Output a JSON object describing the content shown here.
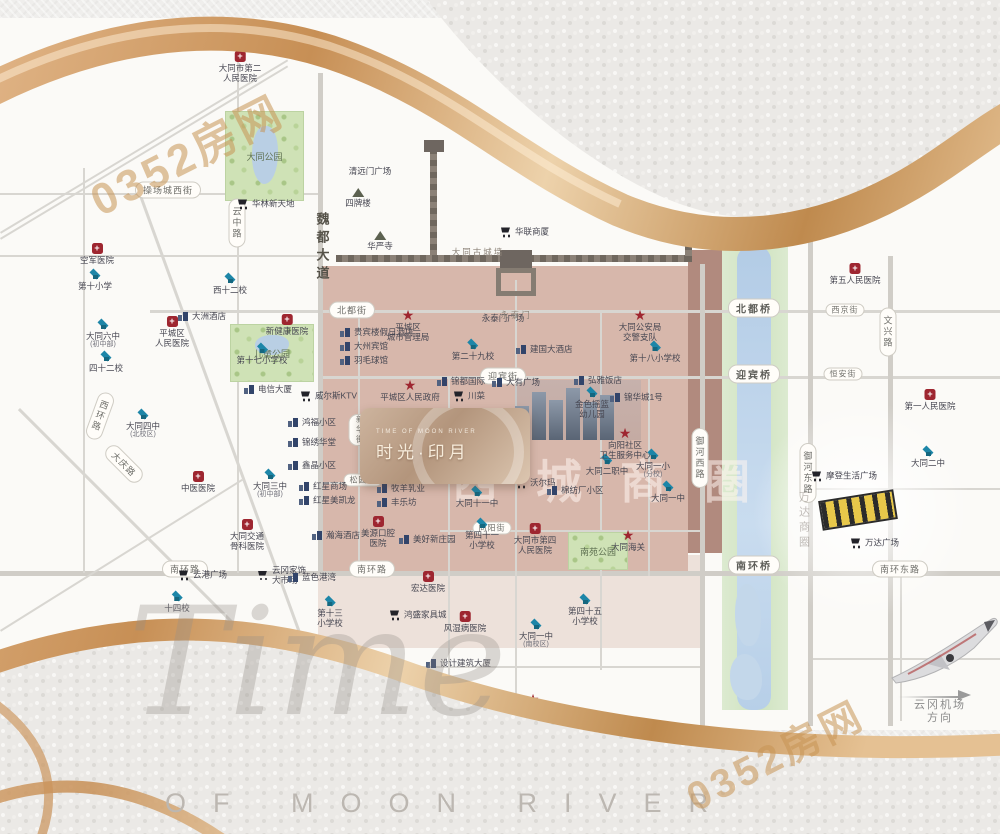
{
  "brand": {
    "script": "Time",
    "line": "OF MOON RIVER"
  },
  "watermark": {
    "text": "0352房网"
  },
  "logo": {
    "en": "TIME OF MOON RIVER",
    "cn": "时光·印月"
  },
  "ghost_label": "西城商圈",
  "map": {
    "parks": [
      {
        "x": 225,
        "y": 93,
        "w": 77,
        "h": 88,
        "label": "大同公园",
        "lake": {
          "x": 26,
          "y": 14,
          "w": 26,
          "h": 58
        }
      },
      {
        "x": 230,
        "y": 306,
        "w": 82,
        "h": 56,
        "label": "儿童公园",
        "lake": {
          "x": 24,
          "y": 10,
          "w": 34,
          "h": 20
        }
      },
      {
        "x": 568,
        "y": 514,
        "w": 58,
        "h": 36,
        "label": "南苑公园",
        "lake": null
      }
    ],
    "roads": [
      {
        "o": "h",
        "x": 0,
        "y": 175,
        "len": 320,
        "w": 2
      },
      {
        "o": "h",
        "x": 0,
        "y": 237,
        "len": 318,
        "w": 2
      },
      {
        "o": "h",
        "x": 150,
        "y": 292,
        "len": 850,
        "w": 3
      },
      {
        "o": "h",
        "x": 318,
        "y": 358,
        "len": 682,
        "w": 3
      },
      {
        "o": "h",
        "x": 318,
        "y": 464,
        "len": 197,
        "w": 2
      },
      {
        "o": "h",
        "x": 440,
        "y": 512,
        "len": 260,
        "w": 2
      },
      {
        "o": "h",
        "x": 0,
        "y": 553,
        "len": 1000,
        "w": 5
      },
      {
        "o": "h",
        "x": 318,
        "y": 648,
        "len": 382,
        "w": 2
      },
      {
        "o": "h",
        "x": 808,
        "y": 470,
        "len": 192,
        "w": 2
      },
      {
        "o": "h",
        "x": 808,
        "y": 640,
        "len": 192,
        "w": 2
      },
      {
        "o": "v",
        "x": 83,
        "y": 150,
        "len": 405,
        "w": 2
      },
      {
        "o": "v",
        "x": 237,
        "y": 30,
        "len": 525,
        "w": 2
      },
      {
        "o": "v",
        "x": 318,
        "y": 55,
        "len": 500,
        "w": 5
      },
      {
        "o": "v",
        "x": 358,
        "y": 292,
        "len": 261,
        "w": 2
      },
      {
        "o": "v",
        "x": 448,
        "y": 358,
        "len": 300,
        "w": 2
      },
      {
        "o": "v",
        "x": 515,
        "y": 262,
        "len": 440,
        "w": 2
      },
      {
        "o": "v",
        "x": 600,
        "y": 292,
        "len": 360,
        "w": 2
      },
      {
        "o": "v",
        "x": 648,
        "y": 358,
        "len": 200,
        "w": 2
      },
      {
        "o": "v",
        "x": 700,
        "y": 246,
        "len": 462,
        "w": 5
      },
      {
        "o": "v",
        "x": 808,
        "y": 222,
        "len": 486,
        "w": 5
      },
      {
        "o": "v",
        "x": 888,
        "y": 238,
        "len": 470,
        "w": 5
      },
      {
        "o": "v",
        "x": 900,
        "y": 553,
        "len": 150,
        "w": 2
      },
      {
        "o": "d",
        "x": 140,
        "y": 172,
        "len": 565,
        "w": 3,
        "ang": 70
      },
      {
        "o": "d",
        "x": 20,
        "y": 390,
        "len": 440,
        "w": 3,
        "ang": 45
      },
      {
        "o": "d",
        "x": 0,
        "y": 612,
        "len": 285,
        "w": 2,
        "ang": -32
      },
      {
        "o": "d",
        "x": 0,
        "y": 214,
        "len": 335,
        "w": 2,
        "ang": -31
      },
      {
        "o": "d",
        "x": 0,
        "y": 220,
        "len": 335,
        "w": 2,
        "ang": -31
      }
    ],
    "capsules": [
      {
        "x": 168,
        "y": 172,
        "t": "操场城西街"
      },
      {
        "x": 237,
        "y": 205,
        "t": "云中路",
        "vert": true
      },
      {
        "x": 322,
        "y": 230,
        "t": "魏都大道",
        "vert": true,
        "plain": true
      },
      {
        "x": 352,
        "y": 292,
        "t": "北都街"
      },
      {
        "x": 503,
        "y": 358,
        "t": "迎宾街"
      },
      {
        "x": 100,
        "y": 398,
        "t": "西环路",
        "vert": true,
        "rot": 20
      },
      {
        "x": 124,
        "y": 446,
        "t": "大庆路",
        "rot": 45
      },
      {
        "x": 700,
        "y": 440,
        "t": "御河西路",
        "vert": true
      },
      {
        "x": 808,
        "y": 455,
        "t": "御河东路",
        "vert": true
      },
      {
        "x": 888,
        "y": 314,
        "t": "文兴路",
        "vert": true
      },
      {
        "x": 185,
        "y": 551,
        "t": "南环路"
      },
      {
        "x": 372,
        "y": 551,
        "t": "南环路"
      },
      {
        "x": 900,
        "y": 551,
        "t": "南环东路"
      },
      {
        "x": 845,
        "y": 292,
        "t": "西京街",
        "small": true
      },
      {
        "x": 843,
        "y": 356,
        "t": "恒安街",
        "small": true
      },
      {
        "x": 363,
        "y": 462,
        "t": "松园街",
        "small": true
      },
      {
        "x": 492,
        "y": 510,
        "t": "向阳街",
        "small": true
      },
      {
        "x": 360,
        "y": 412,
        "t": "新华街",
        "vert": true,
        "small": true
      },
      {
        "x": 452,
        "y": 414,
        "t": "永泰街",
        "vert": true,
        "small": true
      },
      {
        "x": 754,
        "y": 290,
        "t": "北都桥",
        "bridge": true
      },
      {
        "x": 754,
        "y": 356,
        "t": "迎宾桥",
        "bridge": true
      },
      {
        "x": 754,
        "y": 547,
        "t": "南环桥",
        "bridge": true
      }
    ],
    "pois": [
      {
        "t": "school",
        "x": 95,
        "y": 256,
        "l": "第十小学"
      },
      {
        "t": "school",
        "x": 230,
        "y": 260,
        "l": "西十二校"
      },
      {
        "t": "school",
        "x": 103,
        "y": 306,
        "l": "大同六中",
        "s": "(初中部)"
      },
      {
        "t": "school",
        "x": 106,
        "y": 338,
        "l": "四十二校"
      },
      {
        "t": "school",
        "x": 143,
        "y": 396,
        "l": "大同四中",
        "s": "(北校区)"
      },
      {
        "t": "school",
        "x": 262,
        "y": 330,
        "l": "第十七小学校"
      },
      {
        "t": "school",
        "x": 473,
        "y": 326,
        "l": "第二十九校"
      },
      {
        "t": "school",
        "x": 655,
        "y": 328,
        "l": "第十八小学校"
      },
      {
        "t": "school",
        "x": 592,
        "y": 374,
        "l": "金色摇篮\n幼儿园"
      },
      {
        "t": "school",
        "x": 607,
        "y": 441,
        "l": "大同二职中"
      },
      {
        "t": "school",
        "x": 653,
        "y": 436,
        "l": "大同一小",
        "s": "(分校)"
      },
      {
        "t": "school",
        "x": 668,
        "y": 468,
        "l": "大同一中"
      },
      {
        "t": "school",
        "x": 477,
        "y": 473,
        "l": "大同十一中"
      },
      {
        "t": "school",
        "x": 482,
        "y": 505,
        "l": "第四十一\n小学校"
      },
      {
        "t": "school",
        "x": 270,
        "y": 456,
        "l": "大同三中",
        "s": "(初中部)"
      },
      {
        "t": "school",
        "x": 177,
        "y": 578,
        "l": "十四校"
      },
      {
        "t": "school",
        "x": 330,
        "y": 583,
        "l": "第十三\n小学校"
      },
      {
        "t": "school",
        "x": 585,
        "y": 581,
        "l": "第四十五\n小学校"
      },
      {
        "t": "school",
        "x": 536,
        "y": 606,
        "l": "大同一中",
        "s": "(南校区)"
      },
      {
        "t": "school",
        "x": 928,
        "y": 433,
        "l": "大同二中"
      },
      {
        "t": "school",
        "x": 440,
        "y": 660,
        "l": "中心小学校"
      },
      {
        "t": "hospital",
        "x": 240,
        "y": 38,
        "l": "大同市第二\n人民医院"
      },
      {
        "t": "hospital",
        "x": 97,
        "y": 230,
        "l": "空军医院"
      },
      {
        "t": "hospital",
        "x": 172,
        "y": 303,
        "l": "平城区\n人民医院"
      },
      {
        "t": "hospital",
        "x": 287,
        "y": 301,
        "l": "新健康医院"
      },
      {
        "t": "hospital",
        "x": 198,
        "y": 458,
        "l": "中医医院"
      },
      {
        "t": "hospital",
        "x": 247,
        "y": 506,
        "l": "大同交通\n骨科医院"
      },
      {
        "t": "hospital",
        "x": 535,
        "y": 510,
        "l": "大同市第四\n人民医院"
      },
      {
        "t": "hospital",
        "x": 428,
        "y": 558,
        "l": "宏达医院"
      },
      {
        "t": "hospital",
        "x": 465,
        "y": 598,
        "l": "风湿病医院"
      },
      {
        "t": "hospital",
        "x": 855,
        "y": 250,
        "l": "第五人民医院"
      },
      {
        "t": "hospital",
        "x": 930,
        "y": 376,
        "l": "第一人民医院"
      },
      {
        "t": "hospital",
        "x": 378,
        "y": 503,
        "l": "美源口腔\n医院"
      },
      {
        "t": "star",
        "x": 408,
        "y": 296,
        "l": "平城区\n城市管理局"
      },
      {
        "t": "star",
        "x": 410,
        "y": 366,
        "l": "平城区人民政府"
      },
      {
        "t": "star",
        "x": 625,
        "y": 414,
        "l": "向阳社区\n卫生服务中心"
      },
      {
        "t": "star",
        "x": 640,
        "y": 296,
        "l": "大同公安局\n交警支队"
      },
      {
        "t": "star",
        "x": 818,
        "y": 182,
        "l": "大同市人民\n检察院"
      },
      {
        "t": "star",
        "x": 628,
        "y": 516,
        "l": "大同海关"
      },
      {
        "t": "star",
        "x": 533,
        "y": 680,
        "l": "文华派出所"
      },
      {
        "t": "cart",
        "x": 242,
        "y": 186,
        "l": "华林新天地"
      },
      {
        "t": "cart",
        "x": 305,
        "y": 378,
        "l": "威尔斯KTV"
      },
      {
        "t": "cart",
        "x": 458,
        "y": 378,
        "l": "川菜"
      },
      {
        "t": "cart",
        "x": 520,
        "y": 465,
        "l": "沃尔玛"
      },
      {
        "t": "cart",
        "x": 394,
        "y": 597,
        "l": "鸿盛家具城"
      },
      {
        "t": "cart",
        "x": 262,
        "y": 557,
        "l": "云冈家饰\n大市场"
      },
      {
        "t": "cart",
        "x": 183,
        "y": 557,
        "l": "云港广场"
      },
      {
        "t": "cart",
        "x": 816,
        "y": 458,
        "l": "摩登生活广场"
      },
      {
        "t": "cart",
        "x": 855,
        "y": 525,
        "l": "万达广场"
      },
      {
        "t": "cart",
        "x": 505,
        "y": 214,
        "l": "华联商厦"
      },
      {
        "t": "building",
        "x": 346,
        "y": 314,
        "l": "贵宾楼假日酒店"
      },
      {
        "t": "building",
        "x": 346,
        "y": 328,
        "l": "大州宾馆"
      },
      {
        "t": "building",
        "x": 346,
        "y": 342,
        "l": "羽毛球馆"
      },
      {
        "t": "building",
        "x": 294,
        "y": 404,
        "l": "鸿福小区"
      },
      {
        "t": "building",
        "x": 294,
        "y": 424,
        "l": "锦绣华堂"
      },
      {
        "t": "building",
        "x": 294,
        "y": 447,
        "l": "鑫晶小区"
      },
      {
        "t": "building",
        "x": 443,
        "y": 363,
        "l": "锦都国际"
      },
      {
        "t": "building",
        "x": 498,
        "y": 364,
        "l": "大有广场"
      },
      {
        "t": "building",
        "x": 580,
        "y": 362,
        "l": "弘雅饭店"
      },
      {
        "t": "building",
        "x": 616,
        "y": 379,
        "l": "锦华城1号"
      },
      {
        "t": "building",
        "x": 553,
        "y": 472,
        "l": "棉纺厂小区"
      },
      {
        "t": "building",
        "x": 294,
        "y": 559,
        "l": "蓝色港湾"
      },
      {
        "t": "building",
        "x": 522,
        "y": 331,
        "l": "建国大酒店"
      },
      {
        "t": "building",
        "x": 405,
        "y": 521,
        "l": "美好新庄园"
      },
      {
        "t": "building",
        "x": 305,
        "y": 468,
        "l": "红星商场"
      },
      {
        "t": "building",
        "x": 305,
        "y": 482,
        "l": "红星美凯龙"
      },
      {
        "t": "building",
        "x": 318,
        "y": 517,
        "l": "瀚海酒店"
      },
      {
        "t": "building",
        "x": 432,
        "y": 645,
        "l": "设计建筑大厦"
      },
      {
        "t": "building",
        "x": 383,
        "y": 470,
        "l": "牧羊乳业"
      },
      {
        "t": "building",
        "x": 383,
        "y": 484,
        "l": "丰乐坊"
      },
      {
        "t": "building",
        "x": 250,
        "y": 371,
        "l": "电信大厦"
      },
      {
        "t": "building",
        "x": 184,
        "y": 298,
        "l": "大洲酒店"
      },
      {
        "t": "temple",
        "x": 380,
        "y": 218,
        "l": "华严寺"
      },
      {
        "t": "temple",
        "x": 358,
        "y": 175,
        "l": "四牌楼"
      },
      {
        "t": "text",
        "x": 503,
        "y": 300,
        "l": "永泰门广场"
      },
      {
        "t": "text",
        "x": 370,
        "y": 153,
        "l": "清远门广场"
      },
      {
        "t": "text",
        "x": 478,
        "y": 234,
        "l": "大同古城墙",
        "cls": "wall-label"
      },
      {
        "t": "text",
        "x": 516,
        "y": 297,
        "l": "永泰门",
        "cls": "wall-label"
      },
      {
        "t": "text",
        "x": 803,
        "y": 478,
        "l": "万达商圈",
        "cls": "vfaint"
      },
      {
        "t": "text",
        "x": 940,
        "y": 686,
        "l": "云冈机场方向",
        "cls": "airport"
      }
    ]
  }
}
